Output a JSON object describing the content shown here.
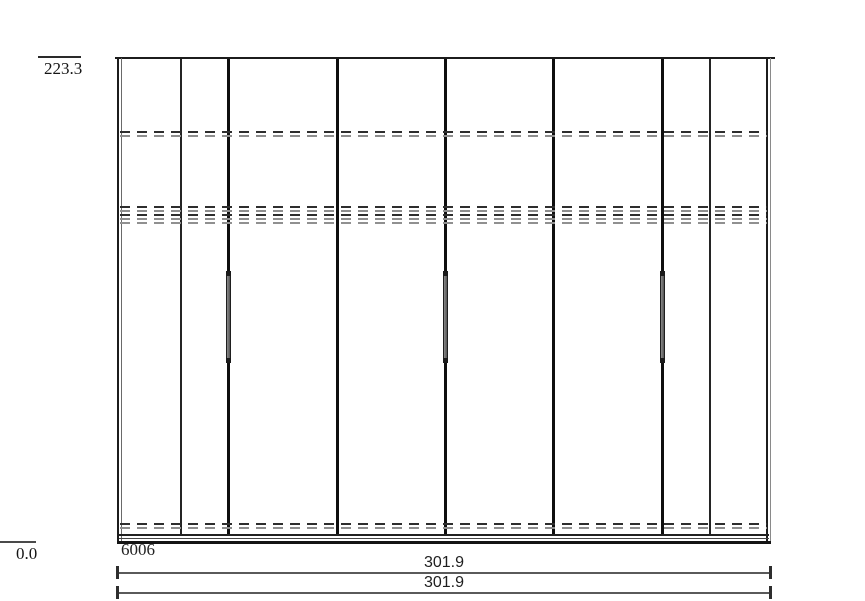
{
  "labels": {
    "top_elevation": "223.3",
    "bottom_elevation": "0.0",
    "item_code": "6006"
  },
  "dimensions": [
    {
      "label": "301.9"
    },
    {
      "label": "301.9"
    }
  ],
  "colors": {
    "background": "#ffffff",
    "line_dark": "#1c1c1c",
    "line_gray": "#8e8e8e",
    "dim_line": "#5a5a5a",
    "handle_fill": "#6e6e6e"
  },
  "diagram": {
    "type": "wardrobe-front-elevation",
    "wardrobe_px": {
      "left": 117,
      "top": 57,
      "width": 654,
      "height": 487
    },
    "vertical_dividers": [
      {
        "x": 63,
        "weight": "thin"
      },
      {
        "x": 110,
        "weight": "thick"
      },
      {
        "x": 219,
        "weight": "thick"
      },
      {
        "x": 327,
        "weight": "thick"
      },
      {
        "x": 435,
        "weight": "thick"
      },
      {
        "x": 544,
        "weight": "thick"
      },
      {
        "x": 592,
        "weight": "thin"
      }
    ],
    "shelf_hidden_lines": [
      {
        "y": 74,
        "style": "pair"
      },
      {
        "y": 149,
        "style": "pair"
      },
      {
        "y": 157,
        "style": "pair"
      },
      {
        "y": 165,
        "style": "single"
      },
      {
        "y": 466,
        "style": "pair"
      }
    ],
    "handles": [
      {
        "x": 110,
        "y": 215,
        "height": 90
      },
      {
        "x": 327,
        "y": 215,
        "height": 90
      },
      {
        "x": 544,
        "y": 215,
        "height": 90
      }
    ],
    "door_panels": [
      {
        "x": 6,
        "width": 56
      },
      {
        "x": 65,
        "width": 45
      },
      {
        "x": 114,
        "width": 105
      },
      {
        "x": 222,
        "width": 105
      },
      {
        "x": 330,
        "width": 105
      },
      {
        "x": 438,
        "width": 106
      },
      {
        "x": 547,
        "width": 45
      },
      {
        "x": 594,
        "width": 54
      }
    ]
  }
}
